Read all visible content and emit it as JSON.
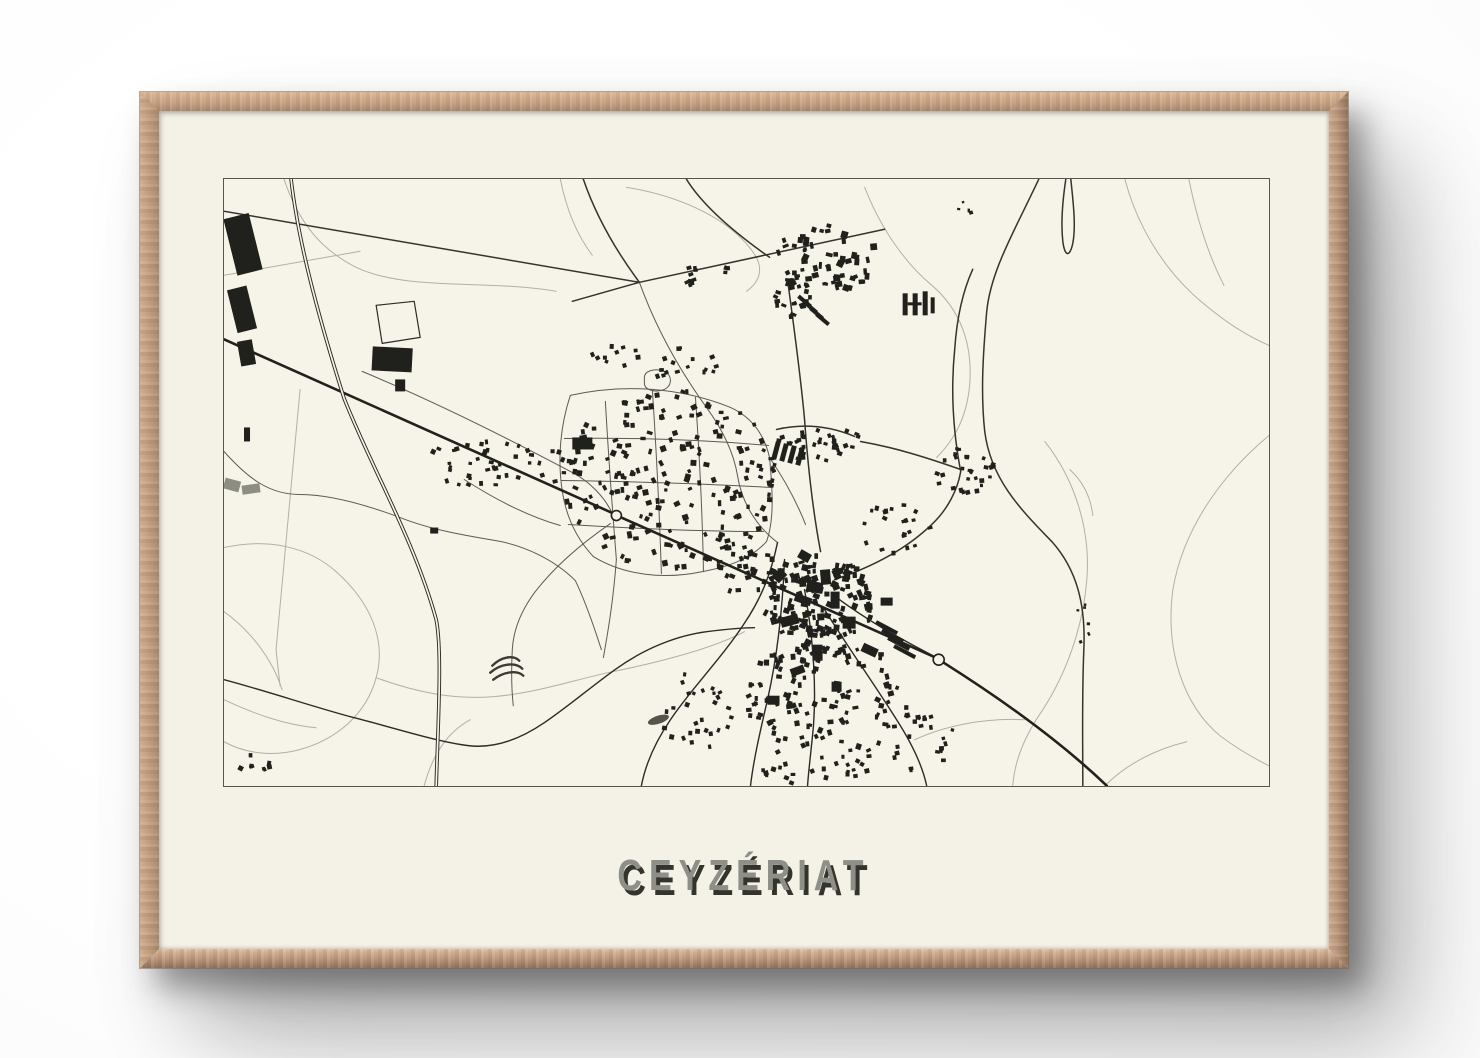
{
  "poster": {
    "title": "CEYZÉRIAT",
    "subject": "minimalist-town-plan-poster",
    "colors": {
      "page_bg": "#ffffff",
      "frame_wood_light": "#dcb998",
      "frame_wood_mid": "#c3a083",
      "frame_wood_dark": "#8f7259",
      "mat": "#f4f1e6",
      "paper": "#f6f4e9",
      "map_border": "#57554d",
      "ink": "#20201c",
      "road_dark": "#2c2b27",
      "road_secondary": "#34332d",
      "road_medium": "#5c5a53",
      "contour_light": "#b2b0a4",
      "title_face": "#8f8f89",
      "title_shadow": "#34342d"
    }
  },
  "map": {
    "viewbox": "0 0 1044 606",
    "layers": [
      {
        "name": "contours-light",
        "stroke": "#b2b0a4",
        "width": 1,
        "paths": [
          "M 60,0 C 74,42 96,70 132,88 C 182,112 262,100 332,112",
          "M 0,96 L 136,72",
          "M 402,8 C 462,18 506,42 528,72 C 540,88 536,102 522,112",
          "M 640,8 C 656,50 682,85 706,105 C 736,130 748,165 745,205 C 742,240 728,262 712,278",
          "M 900,0 C 912,45 936,85 968,115 C 1005,148 1030,160 1044,166",
          "M 964,0 C 972,40 983,75 999,106",
          "M 1044,256 C 996,296 958,350 948,410 C 940,470 958,525 995,556 C 1015,571 1032,580 1044,586",
          "M 820,262 C 850,300 866,350 862,400 C 858,450 840,496 818,530 C 800,556 790,580 788,606",
          "M 0,368 C 45,358 85,368 112,392 C 148,424 162,462 152,498 C 142,535 112,560 75,570 C 45,578 18,572 0,562",
          "M 0,432 C 25,450 48,478 58,510",
          "M 152,498 C 190,512 228,520 268,517 C 310,514 350,500 388,492 C 438,482 490,468 520,452",
          "M 200,606 C 208,576 222,553 246,540",
          "M 690,560 C 720,546 760,538 800,540",
          "M 880,606 C 900,586 928,570 962,562",
          "M 76,210 L 52,470 L 56,506",
          "M 336,0 C 342,30 352,55 368,76",
          "M 845,290 C 858,302 866,318 868,336",
          "M 0,520 C 30,534 60,545 92,548"
        ]
      },
      {
        "name": "streets-medium",
        "stroke": "#5c5a53",
        "width": 1,
        "paths": [
          "M 346,216 C 400,204 456,208 506,228",
          "M 506,228 C 528,238 540,256 545,278 C 548,310 550,340 542,362",
          "M 346,216 C 336,246 333,280 338,312 C 342,338 353,360 369,377",
          "M 369,377 C 400,396 440,400 478,392 C 500,388 525,381 542,362",
          "M 381,222 C 384,275 388,330 392,380",
          "M 428,211 C 432,272 435,332 437,394",
          "M 471,218 C 475,276 478,334 479,392",
          "M 340,259 C 408,258 476,260 544,266",
          "M 337,301 C 407,302 477,304 547,308",
          "M 344,345 C 410,349 475,352 539,352",
          "M 392,380 C 389,420 384,450 379,478",
          "M 138,192 C 210,222 282,258 346,292 C 366,302 380,318 387,332",
          "M 240,300 C 268,318 301,336 336,346",
          "M 386,344 C 360,362 331,386 311,412 C 296,432 289,452 288,470 C 287,490 287,508 289,526",
          "M 415,103 C 432,150 456,192 482,228 C 498,250 509,272 513,296 C 517,322 531,346 553,363",
          "M 0,272 C 25,300 46,315 76,315 C 106,315 141,325 176,338 C 206,350 241,356 271,361 C 301,366 331,381 351,401 C 362,424 370,448 377,470",
          "M 420,198 C 420,192 430,188 440,192 C 448,196 448,206 440,210 C 430,214 420,210 420,204 Z",
          "M 545,278 C 560,300 572,322 581,345"
        ]
      },
      {
        "name": "roads-secondary-dark",
        "stroke": "#34332d",
        "width": 1.5,
        "paths": [
          "M 0,32 L 415,103",
          "M 348,122 L 415,103 L 660,50",
          "M 359,0 C 372,38 392,72 415,103",
          "M 564,108 C 570,152 576,196 580,240 C 583,282 588,330 596,372",
          "M 552,250 C 578,244 604,246 630,257",
          "M 636,262 C 670,268 702,278 736,290",
          "M 736,292 C 728,250 726,210 730,170 C 732,140 738,112 748,90",
          "M 610,400 C 646,388 681,370 707,345 C 723,330 733,310 736,292",
          "M 814,0 C 788,55 766,92 762,132 C 758,178 756,215 760,252 C 766,300 796,330 827,362 C 852,390 861,425 859,470 C 857,520 858,560 858,606",
          "M 846,0 C 849,28 851,48 848,64 C 845,78 840,78 838,62 C 836,44 838,20 841,0",
          "M 462,0 C 478,26 508,52 545,78"
        ]
      },
      {
        "name": "town-roads",
        "stroke": "#2c2b27",
        "width": 1.4,
        "paths": [
          "M 553,363 C 546,396 536,420 519,445 C 496,480 466,510 446,540 C 431,562 421,585 417,606",
          "M 560,380 C 558,430 552,480 543,520 C 536,550 529,580 526,606",
          "M 580,410 C 588,455 592,500 589,545 C 587,568 584,590 583,606",
          "M 600,430 C 625,470 650,505 672,540 C 688,565 698,587 702,606",
          "M 612,418 C 650,446 682,462 708,476",
          "M 0,500 C 45,512 92,528 130,538 C 170,548 212,562 245,566 C 272,569 298,558 320,543 C 345,526 368,506 392,489 C 420,469 452,456 482,452 C 498,450 515,448 530,448"
        ]
      },
      {
        "name": "highway",
        "stroke": "#22211d",
        "width": 2.6,
        "paths": [
          "M 0,160 L 387,333",
          "M 397,338 L 709,477",
          "M 719,483 C 776,519 836,562 882,606"
        ]
      }
    ],
    "railway": {
      "path": "M 67,0 C 74,60 92,130 120,219 C 148,290 190,360 212,440 C 218,470 214,540 212,606",
      "outer_stroke": "#2a2a25",
      "outer_width": 3.6,
      "inner_width": 1.7
    },
    "roundabouts": [
      {
        "cx": 392,
        "cy": 336,
        "r": 5
      },
      {
        "cx": 714,
        "cy": 480,
        "r": 5.5
      }
    ],
    "field_outline": {
      "path": "M 152,126 L 190,122 L 196,158 L 158,164 Z",
      "stroke": "#2c2b27",
      "width": 1.2
    },
    "terrace_arcs": {
      "stroke": "#3b3a34",
      "width": 2.4,
      "paths": [
        "M 268,486 C 277,477 289,475 295,481",
        "M 266,493 C 276,484 291,482 298,489",
        "M 269,500 C 279,492 293,490 299,496"
      ]
    },
    "pond": {
      "cx": 434,
      "cy": 540,
      "rx": 11,
      "ry": 4,
      "rot": -18,
      "fill": "#55544b"
    },
    "buildings": [
      [
        6,
        36,
        26,
        58,
        -14
      ],
      [
        8,
        108,
        20,
        44,
        -14
      ],
      [
        15,
        161,
        15,
        25,
        -10
      ],
      [
        148,
        168,
        40,
        24,
        3
      ],
      [
        171,
        200,
        10,
        12,
        0
      ],
      [
        348,
        258,
        20,
        12,
        0
      ],
      [
        206,
        348,
        8,
        6,
        0
      ],
      [
        20,
        248,
        6,
        14,
        0
      ],
      [
        582,
        402,
        16,
        11,
        10
      ],
      [
        596,
        390,
        10,
        15,
        -5
      ],
      [
        570,
        416,
        17,
        8,
        20
      ],
      [
        606,
        412,
        9,
        17,
        0
      ],
      [
        556,
        436,
        18,
        10,
        -15
      ],
      [
        618,
        437,
        13,
        12,
        0
      ],
      [
        637,
        466,
        16,
        9,
        25
      ],
      [
        588,
        465,
        10,
        16,
        0
      ],
      [
        566,
        487,
        14,
        8,
        -20
      ],
      [
        543,
        516,
        12,
        9,
        0
      ],
      [
        607,
        502,
        10,
        10,
        0
      ],
      [
        656,
        418,
        12,
        8,
        0
      ],
      [
        574,
        372,
        12,
        9,
        30
      ],
      [
        550,
        390,
        10,
        12,
        45
      ],
      [
        650,
        446,
        24,
        4,
        28
      ],
      [
        656,
        454,
        24,
        4,
        28
      ],
      [
        662,
        462,
        24,
        4,
        28
      ],
      [
        668,
        470,
        24,
        4,
        28
      ],
      [
        549,
        262,
        5,
        18,
        15
      ],
      [
        557,
        264,
        5,
        18,
        15
      ],
      [
        565,
        266,
        5,
        18,
        15
      ],
      [
        573,
        268,
        5,
        18,
        15
      ],
      [
        572,
        120,
        16,
        4,
        40
      ],
      [
        578,
        126,
        16,
        4,
        40
      ],
      [
        584,
        132,
        16,
        4,
        40
      ],
      [
        590,
        138,
        16,
        4,
        40
      ],
      [
        678,
        114,
        5,
        22,
        0
      ],
      [
        688,
        114,
        5,
        22,
        0
      ],
      [
        683,
        123,
        14,
        3,
        0
      ],
      [
        698,
        112,
        5,
        24,
        0
      ],
      [
        706,
        118,
        4,
        16,
        0
      ],
      [
        0,
        300,
        16,
        11,
        15,
        "#8d8d82"
      ],
      [
        18,
        305,
        18,
        9,
        -8,
        "#8d8d82"
      ]
    ],
    "building_fill": "#20201c",
    "clusters": [
      {
        "seed": 106,
        "cx": 600,
        "cy": 78,
        "rx": 52,
        "ry": 34,
        "count": 60,
        "min": 3,
        "max": 7
      },
      {
        "seed": 205,
        "cx": 568,
        "cy": 118,
        "rx": 22,
        "ry": 18,
        "count": 22,
        "min": 3,
        "max": 6
      },
      {
        "seed": 304,
        "cx": 478,
        "cy": 95,
        "rx": 28,
        "ry": 16,
        "count": 12,
        "min": 3,
        "max": 5
      },
      {
        "seed": 403,
        "cx": 442,
        "cy": 298,
        "rx": 108,
        "ry": 92,
        "count": 200,
        "min": 3,
        "max": 6
      },
      {
        "seed": 502,
        "cx": 290,
        "cy": 282,
        "rx": 55,
        "ry": 26,
        "count": 26,
        "min": 3,
        "max": 5
      },
      {
        "seed": 601,
        "cx": 255,
        "cy": 280,
        "rx": 60,
        "ry": 28,
        "count": 20,
        "min": 3,
        "max": 5
      },
      {
        "seed": 700,
        "cx": 592,
        "cy": 420,
        "rx": 55,
        "ry": 48,
        "count": 150,
        "min": 3,
        "max": 7
      },
      {
        "seed": 809,
        "cx": 600,
        "cy": 515,
        "rx": 85,
        "ry": 55,
        "count": 120,
        "min": 3,
        "max": 6
      },
      {
        "seed": 908,
        "cx": 470,
        "cy": 530,
        "rx": 40,
        "ry": 40,
        "count": 28,
        "min": 3,
        "max": 5
      },
      {
        "seed": 1007,
        "cx": 592,
        "cy": 262,
        "rx": 44,
        "ry": 18,
        "count": 34,
        "min": 3,
        "max": 5
      },
      {
        "seed": 1106,
        "cx": 738,
        "cy": 290,
        "rx": 30,
        "ry": 26,
        "count": 30,
        "min": 3,
        "max": 5
      },
      {
        "seed": 1205,
        "cx": 668,
        "cy": 350,
        "rx": 38,
        "ry": 28,
        "count": 22,
        "min": 3,
        "max": 5
      },
      {
        "seed": 1304,
        "cx": 742,
        "cy": 32,
        "rx": 12,
        "ry": 12,
        "count": 4,
        "min": 2,
        "max": 4
      },
      {
        "seed": 1403,
        "cx": 858,
        "cy": 445,
        "rx": 10,
        "ry": 28,
        "count": 6,
        "min": 2,
        "max": 4
      },
      {
        "seed": 1502,
        "cx": 25,
        "cy": 582,
        "rx": 20,
        "ry": 9,
        "count": 8,
        "min": 3,
        "max": 5
      },
      {
        "seed": 1601,
        "cx": 385,
        "cy": 175,
        "rx": 30,
        "ry": 12,
        "count": 10,
        "min": 3,
        "max": 5
      },
      {
        "seed": 1700,
        "cx": 460,
        "cy": 185,
        "rx": 35,
        "ry": 20,
        "count": 16,
        "min": 3,
        "max": 5
      },
      {
        "seed": 1809,
        "cx": 520,
        "cy": 390,
        "rx": 30,
        "ry": 25,
        "count": 30,
        "min": 3,
        "max": 6
      },
      {
        "seed": 1908,
        "cx": 690,
        "cy": 560,
        "rx": 40,
        "ry": 30,
        "count": 25,
        "min": 3,
        "max": 5
      },
      {
        "seed": 2007,
        "cx": 590,
        "cy": 580,
        "rx": 60,
        "ry": 25,
        "count": 30,
        "min": 3,
        "max": 5
      }
    ]
  }
}
